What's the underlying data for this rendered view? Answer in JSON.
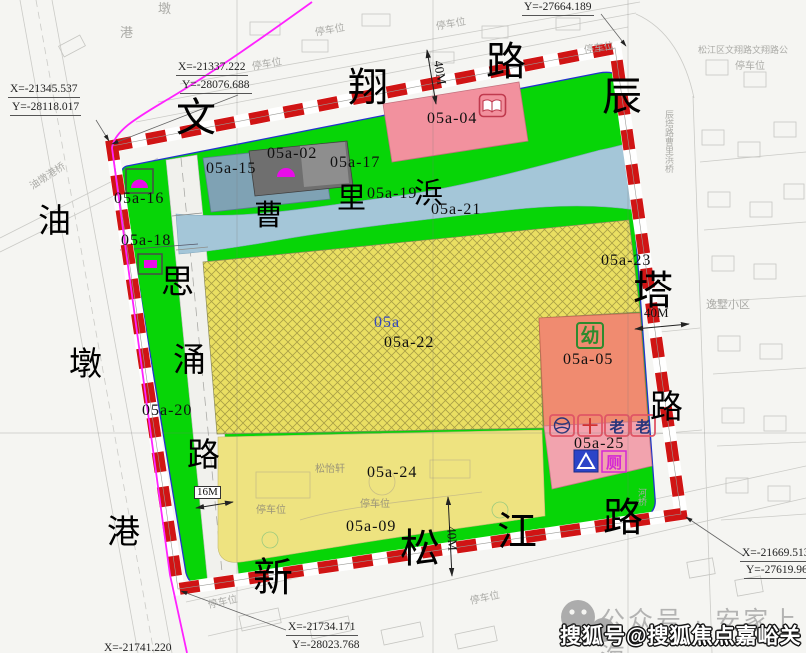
{
  "parcel_labels": {
    "p15": "05a-15",
    "p02": "05a-02",
    "p17": "05a-17",
    "p04": "05a-04",
    "p19": "05a-19",
    "p21": "05a-21",
    "p16": "05a-16",
    "p18": "05a-18",
    "p23": "05a-23",
    "p05": "05a-05",
    "p20": "05a-20",
    "p22_prefix": "05a",
    "p22": "05a-22",
    "p24": "05a-24",
    "p25": "05a-25",
    "p09": "05a-09"
  },
  "road_names": {
    "wen": "文",
    "xiang": "翔",
    "lu_top": "路",
    "chen": "辰",
    "ta": "塔",
    "lu_right": "路",
    "xin": "新",
    "song": "松",
    "jiang": "江",
    "lu_bottom": "路",
    "you": "油",
    "dun": "墩",
    "gang": "港",
    "si": "思",
    "yong": "涌",
    "lu_left": "路",
    "cao": "曹",
    "li": "里",
    "bang": "浜"
  },
  "coordinates": {
    "c1x": "X=-21337.222",
    "c1y": "Y=-28076.688",
    "c2x": "X=-21345.537",
    "c2y": "Y=-28118.017",
    "c3y": "Y=-27664.189",
    "c4x": "X=-21669.513",
    "c4y": "Y=-27619.968",
    "c5x": "X=-21734.171",
    "c5y": "Y=-28023.768",
    "c6x": "X=-21741.220"
  },
  "dimensions": {
    "top": "40M",
    "right": "40M",
    "left": "16M",
    "bottom": "40M"
  },
  "icon_glyphs": {
    "kindergarten": "幼",
    "toilet": "厕",
    "clinic": "十",
    "elder": "老"
  },
  "background_labels": {
    "parking": "停车位",
    "estate": "逸墅小区",
    "bus_note": "松江区文翔路文翔路公",
    "canal_bridge": "油墩港桥",
    "chenta_bridge": "辰塔路曹里浜桥",
    "river_bridge": "河桥",
    "songyixuan": "松怡轩",
    "dun": "墩",
    "gang": "港"
  },
  "watermark": {
    "wechat": "公众号 · 安家上海",
    "sohu": "搜狐号@搜狐焦点嘉峪关站"
  }
}
